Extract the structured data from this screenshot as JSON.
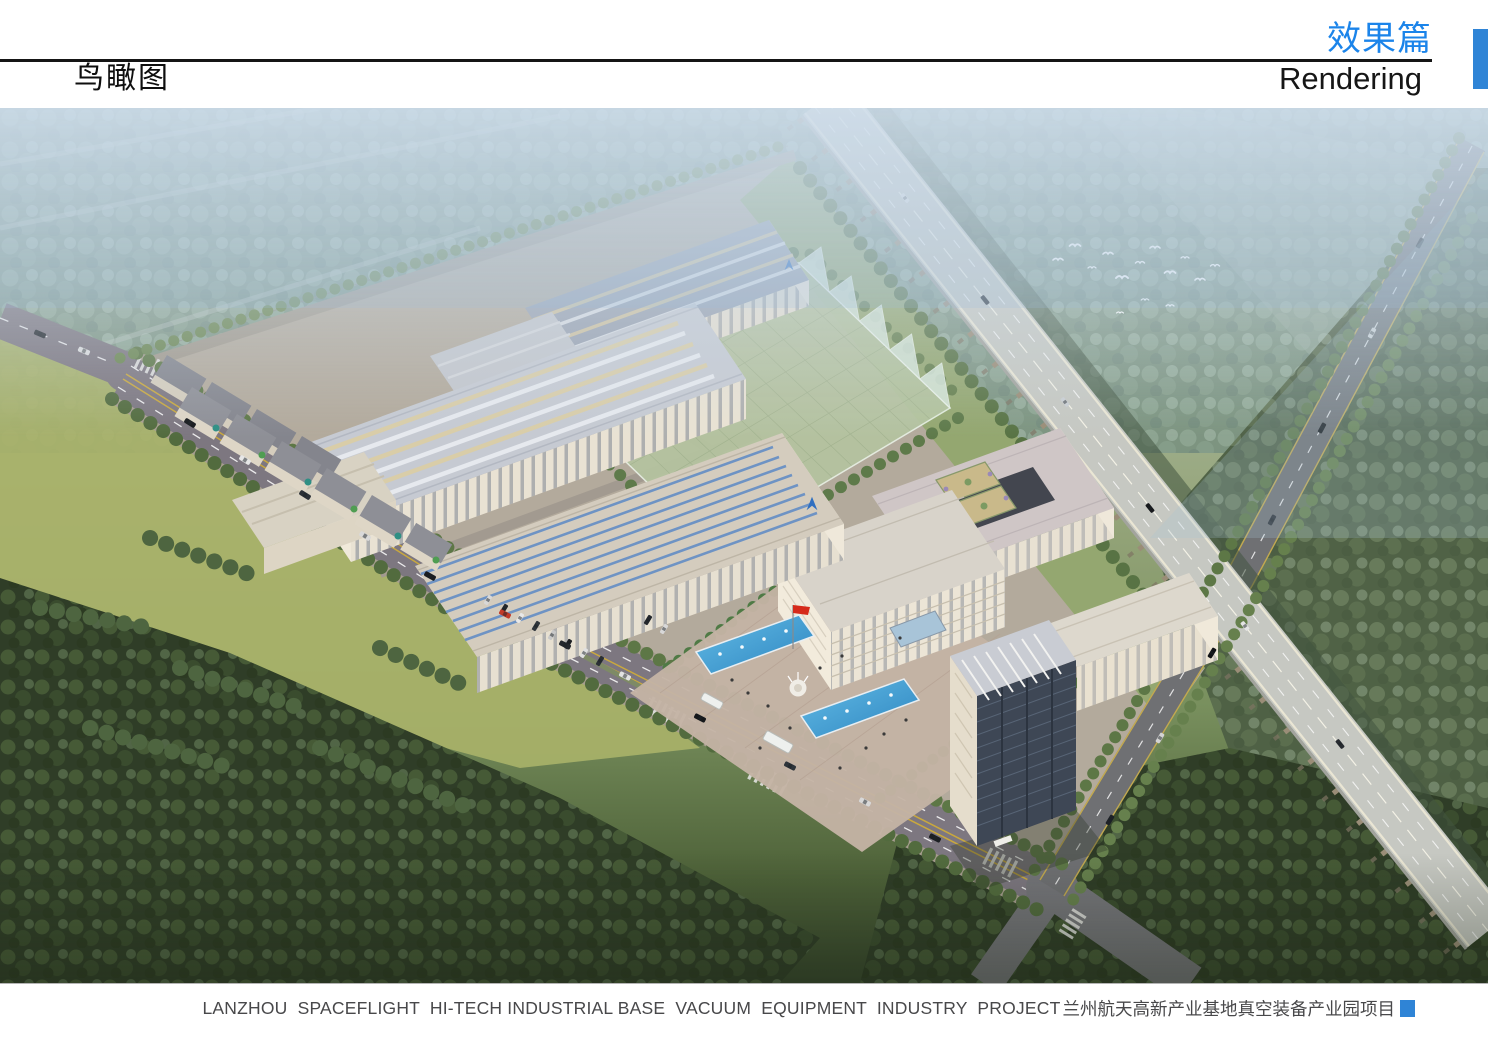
{
  "header": {
    "section_title_zh": "效果篇",
    "section_title_en": "Rendering",
    "page_title_zh": "鸟瞰图"
  },
  "footer": {
    "caption_en": "LANZHOU  SPACEFLIGHT  HI-TECH INDUSTRIAL BASE  VACUUM  EQUIPMENT  INDUSTRY  PROJECT",
    "caption_zh": "兰州航天高新产业基地真空装备产业园项目"
  },
  "colors": {
    "accent_blue": "#2f84d6",
    "heading_blue": "#1b84ea",
    "rule_black": "#151515",
    "caption_gray": "#48484a"
  },
  "scene": {
    "description": "Aerial bird's-eye architectural rendering of an industrial park: long factory halls with skylight roofs, a translucent green covered field, courtyard office buildings, a high-rise tower, an entrance plaza with fountain pools and a red flag, tree-lined roads with cars, an elevated expressway crossing diagonally, farmland and forests around, and a flock of white birds."
  }
}
